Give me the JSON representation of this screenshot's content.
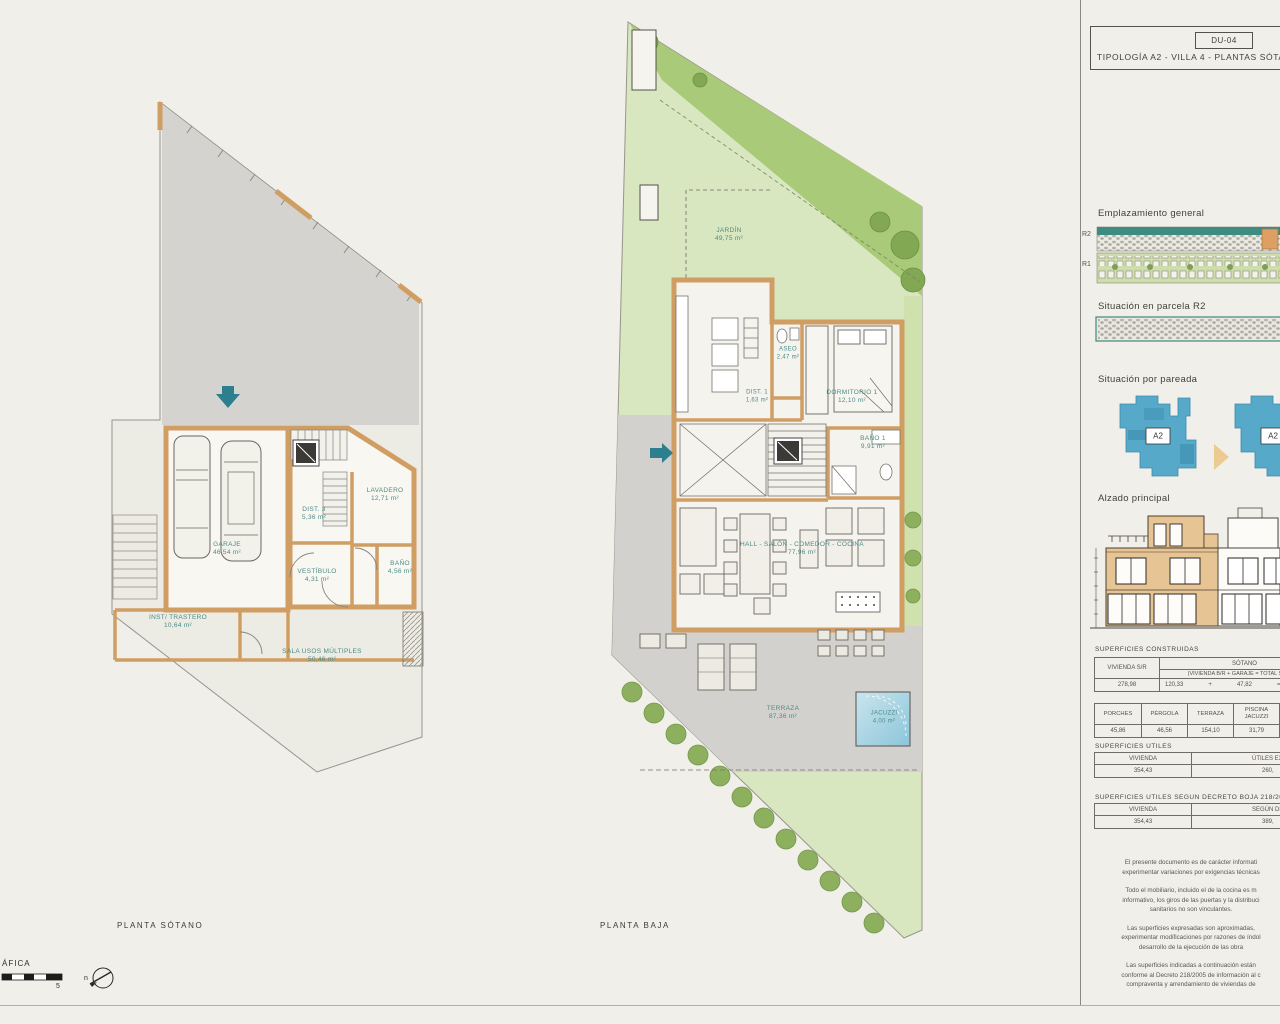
{
  "sheet": {
    "code": "DU-04",
    "title": "TIPOLOGÍA A2 - VILLA 4 - PLANTAS SÓTA"
  },
  "plans": {
    "sotano": {
      "caption": "PLANTA SÓTANO",
      "garaje": {
        "name": "GARAJE",
        "area": "46,54 m²"
      },
      "dist3": {
        "name": "DIST. 3",
        "area": "5,36 m²"
      },
      "lavadero": {
        "name": "LAVADERO",
        "area": "12,71 m²"
      },
      "vestibulo": {
        "name": "VESTÍBULO",
        "area": "4,31 m²"
      },
      "bano": {
        "name": "BAÑO",
        "area": "4,56 m²"
      },
      "trastero": {
        "name": "INST/ TRASTERO",
        "area": "10,64 m²"
      },
      "sala": {
        "name": "SALA USOS MÚLTIPLES",
        "area": "50,46 m²"
      }
    },
    "baja": {
      "caption": "PLANTA BAJA",
      "jardin": {
        "name": "JARDÍN",
        "area": "49,75 m²"
      },
      "aseo": {
        "name": "ASEO",
        "area": "2,47 m²"
      },
      "dist1": {
        "name": "DIST. 1",
        "area": "1,63 m²"
      },
      "dormitorio1": {
        "name": "DORMITORIO 1",
        "area": "12,10 m²"
      },
      "bano1": {
        "name": "BAÑO 1",
        "area": "9,91 m²"
      },
      "salon": {
        "name": "HALL - SALÓN - COMEDOR - COCINA",
        "area": "77,96 m²"
      },
      "terraza": {
        "name": "TERRAZA",
        "area": "87,36 m²"
      },
      "jacuzzi": {
        "name": "JACUZZI",
        "area": "4,00 m²"
      }
    }
  },
  "sidebar": {
    "emplazamiento": {
      "label": "Emplazamiento general",
      "r2": "R2",
      "r1": "R1"
    },
    "parcela": {
      "label": "Situación en parcela R2"
    },
    "pareada": {
      "label": "Situación por pareada",
      "left_unit": "A2",
      "right_unit": "A2"
    },
    "alzado": {
      "label": "Alzado principal"
    },
    "construidas": {
      "title": "SUPERFICIES CONSTRUIDAS",
      "col_vivienda": "VIVIENDA S/R",
      "col_sotano": "SÓTANO",
      "col_sotano_sub": "(VIVIENDA B/R + GARAJE = TOTAL SÓTANO",
      "vivienda_value": "278,98",
      "sotano_a": "120,33",
      "plus": "+",
      "sotano_b": "47,82",
      "equals": "=",
      "sotano_total": "168,15",
      "headers2": [
        "PORCHES",
        "PÉRGOLA",
        "TERRAZA",
        "PISCINA JACUZZI"
      ],
      "values2": [
        "45,86",
        "46,56",
        "154,10",
        "31,79"
      ]
    },
    "utiles": {
      "title": "SUPERFICIES ÚTILES",
      "col1": "VIVIENDA",
      "col2": "ÚTILES EXT",
      "val1": "354,43",
      "val2": "260,"
    },
    "decreto": {
      "title": "SUPERFICIES ÚTILES SEGÚN DECRETO BOJA 218/2005",
      "col1": "VIVIENDA",
      "col2": "SEGÚN DE",
      "val1": "354,43",
      "val2": "389,"
    },
    "disclaimer": [
      "El presente documento es de carácter informati",
      "experimentar variaciones por exigencias técnicas",
      "Todo el mobiliario, incluido el de la cocina es m",
      "informativo, los giros de las puertas y la distribuci",
      "sanitarios no son vinculantes.",
      "Las superficies expresadas son aproximadas,",
      "experimentar modificaciones por razones de índol",
      "desarrollo de la ejecución de las obra",
      "Las superficies indicadas a continuación están",
      "conforme al Decreto 218/2005 de información al c",
      "compraventa  y arrendamiento de viviendas de"
    ]
  },
  "footer": {
    "scale_label": "ÁFICA",
    "scale_max": "5",
    "north": "n"
  }
}
